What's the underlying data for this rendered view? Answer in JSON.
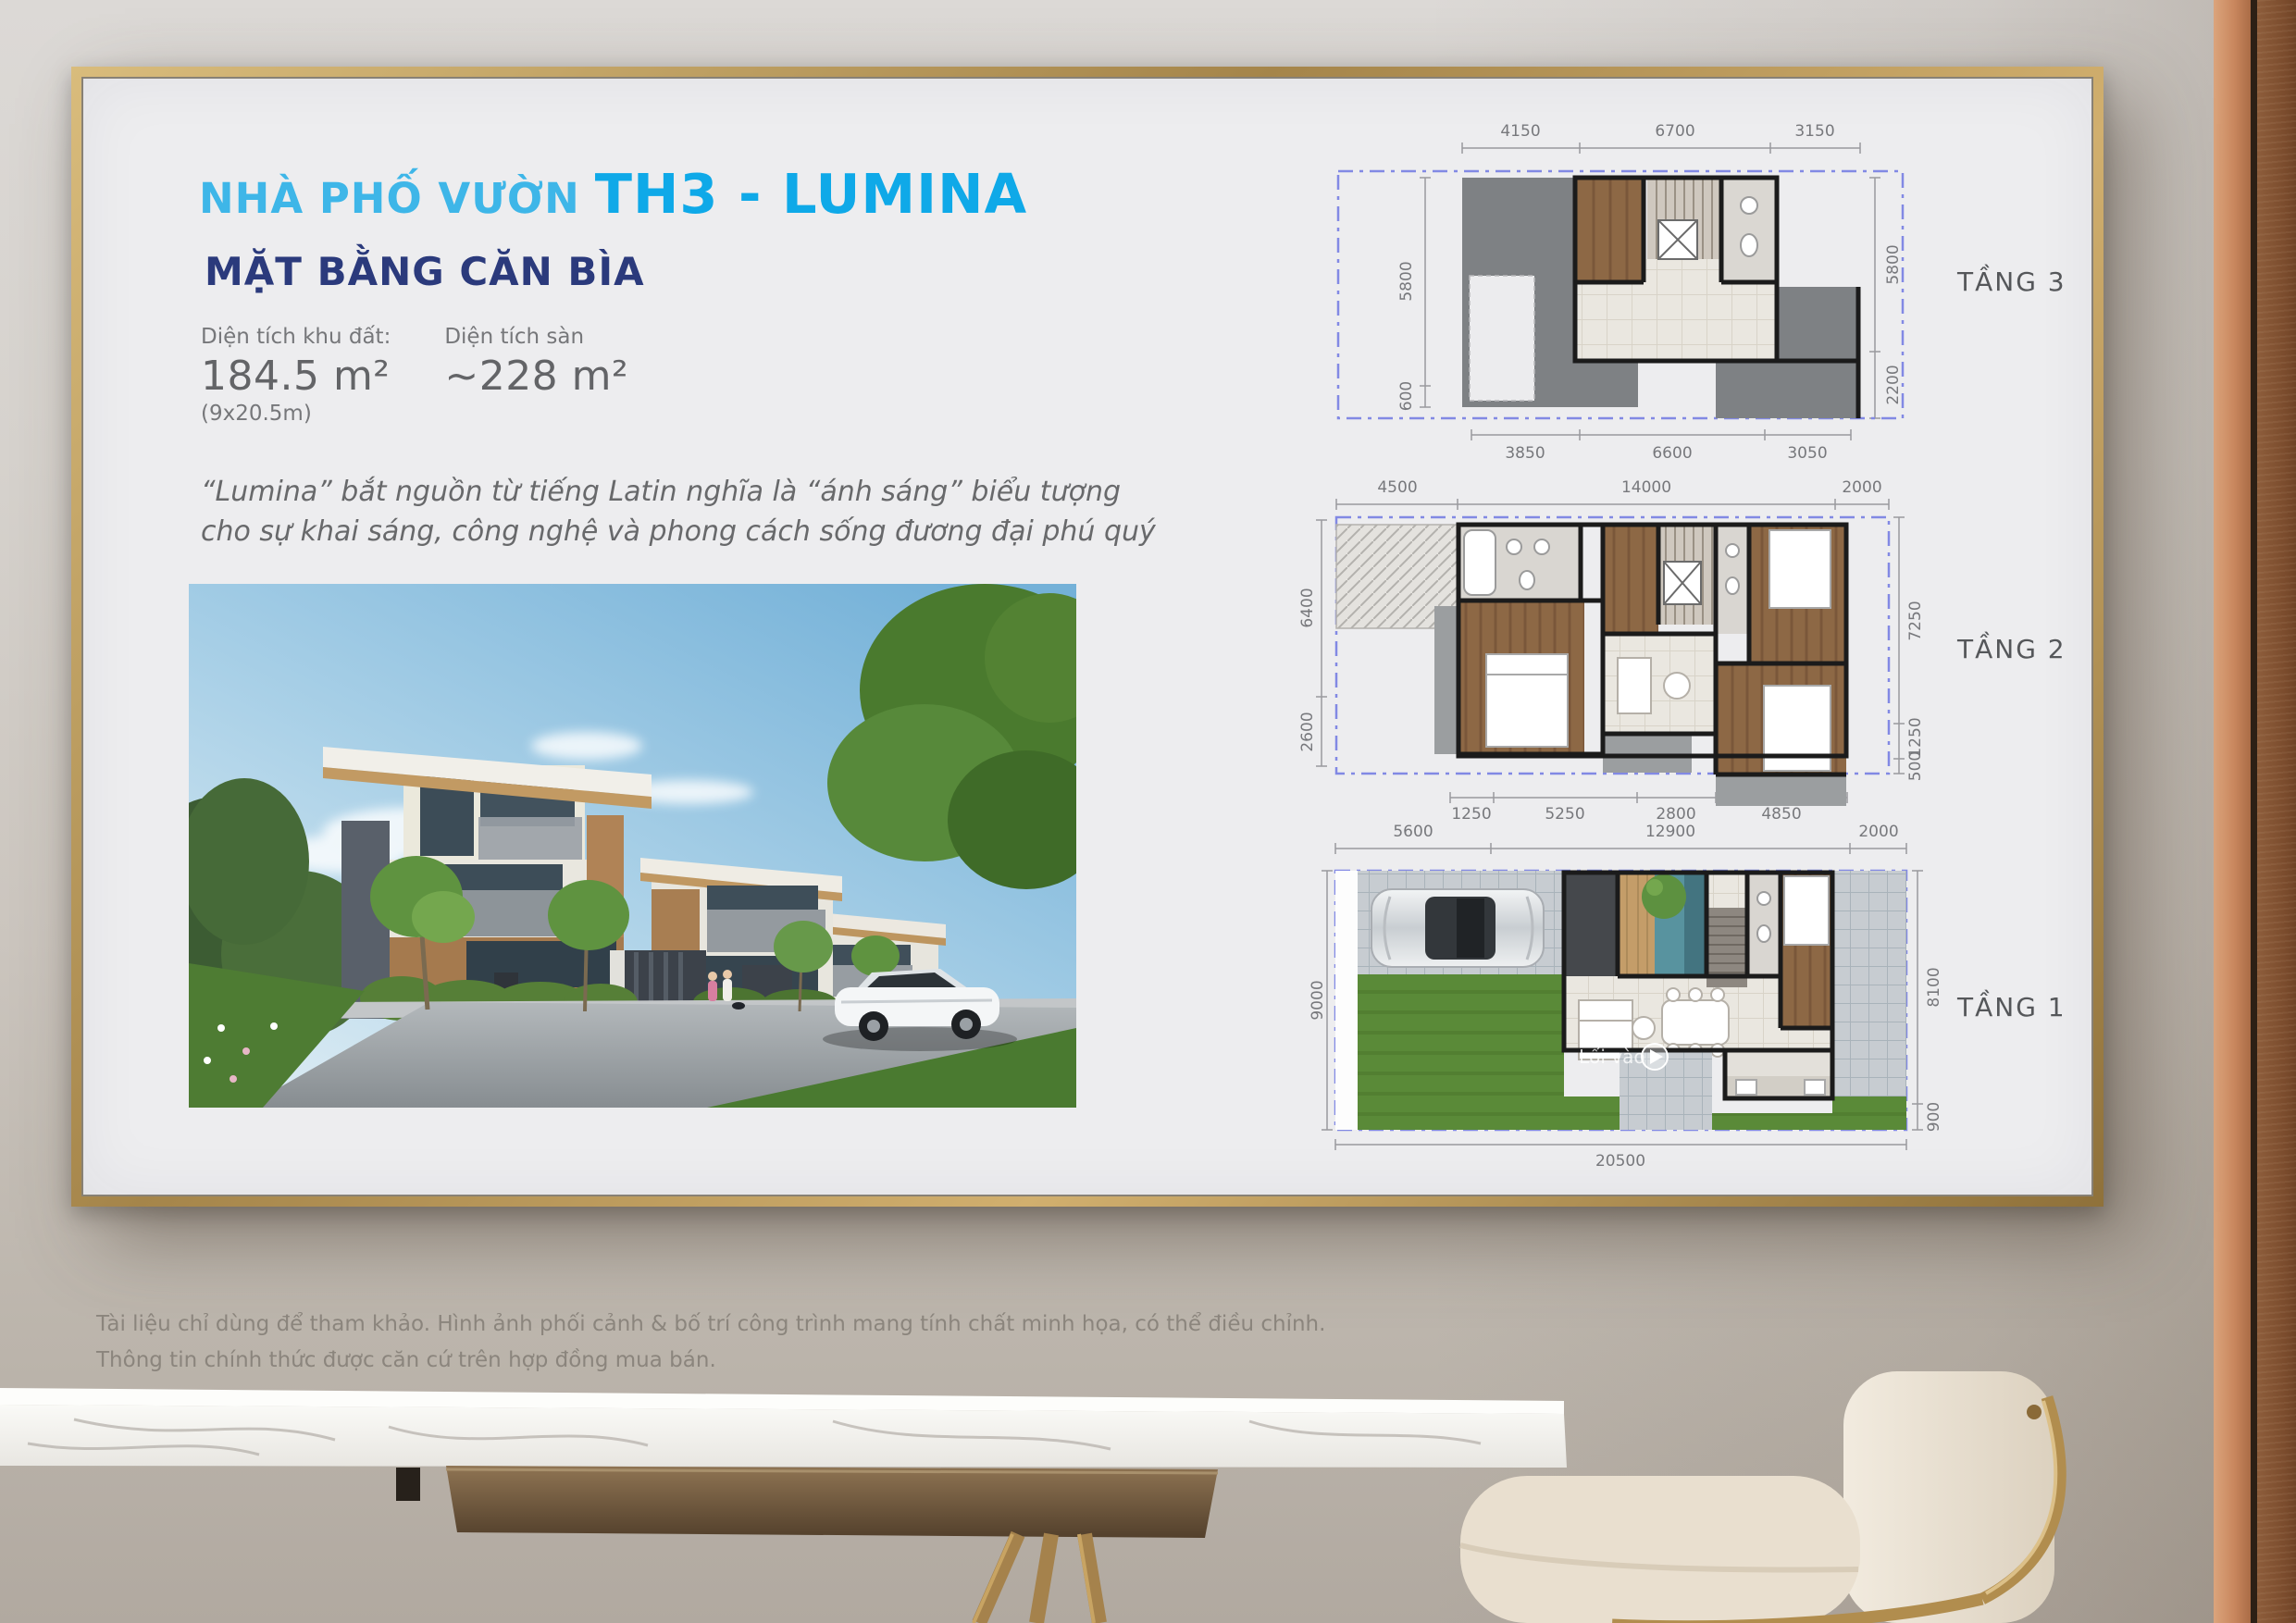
{
  "poster": {
    "title_prefix": "NHÀ PHỐ VƯỜN",
    "title_main": "TH3 - LUMINA",
    "subtitle": "MẶT BẰNG CĂN BÌA",
    "stats": {
      "land_label": "Diện tích khu đất:",
      "land_value": "184.5 m²",
      "land_note": "(9x20.5m)",
      "floor_label": "Diện tích sàn",
      "floor_value": "~228 m²"
    },
    "quote": {
      "line1": "“Lumina” bắt nguồn từ tiếng Latin nghĩa là “ánh sáng” biểu tượng",
      "line2": "cho sự khai sáng, công nghệ và phong cách sống đương đại phú quý"
    },
    "plans": [
      {
        "label": "TẦNG 3",
        "top": [
          "4150",
          "6700",
          "3150"
        ],
        "bottom": [
          "3850",
          "6600",
          "3050"
        ],
        "left": [
          "5800",
          "600"
        ],
        "right": [
          "5800",
          "2200"
        ]
      },
      {
        "label": "TẦNG 2",
        "top": [
          "4500",
          "14000",
          "2000"
        ],
        "bottom": [
          "1250",
          "5250",
          "2800",
          "4850"
        ],
        "left": [
          "6400",
          "2600"
        ],
        "right": [
          "7250",
          "1250",
          "500"
        ]
      },
      {
        "label": "TẦNG 1",
        "top": [
          "5600",
          "12900",
          "2000"
        ],
        "bottom": [
          "20500"
        ],
        "left": [
          "9000"
        ],
        "right": [
          "8100",
          "900"
        ],
        "watermark": "Lối vào"
      }
    ]
  },
  "disclaimer": {
    "line1": "Tài liệu chỉ dùng để tham khảo. Hình ảnh phối cảnh & bố trí công trình mang tính chất minh họa, có thể điều chỉnh.",
    "line2": "Thông tin chính thức được căn cứ trên hợp đồng mua bán."
  },
  "colors": {
    "accent_blue": "#0fa9e8",
    "accent_light_blue": "#3eb6e8",
    "navy": "#2b3a7c",
    "frame_gold": "#b29157",
    "lot_boundary": "#8289e4"
  }
}
